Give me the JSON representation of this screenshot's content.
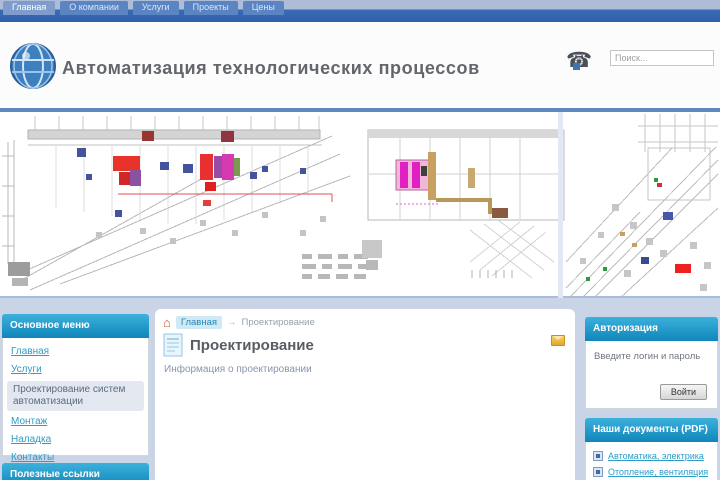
{
  "topnav": {
    "tabs": [
      {
        "label": "Главная"
      },
      {
        "label": "О компании"
      },
      {
        "label": "Услуги"
      },
      {
        "label": "Проекты"
      },
      {
        "label": "Цены"
      }
    ]
  },
  "header": {
    "site_title": "Автоматизация технологических процессов",
    "search_placeholder": "Поиск..."
  },
  "icons": {
    "home": "⌂",
    "phone": "☎"
  },
  "left_sidebar": {
    "menu_title": "Основное меню",
    "items": [
      {
        "label": "Главная"
      },
      {
        "label": "Услуги"
      },
      {
        "label": "Проектирование систем автоматизации"
      },
      {
        "label": "Монтаж"
      },
      {
        "label": "Наладка"
      },
      {
        "label": "Контакты"
      }
    ],
    "bottom_module_title": "Полезные ссылки"
  },
  "content": {
    "breadcrumb": {
      "home": "Главная",
      "separator": "→",
      "current": "Проектирование"
    },
    "article": {
      "title": "Проектирование",
      "subtitle": "Информация о проектировании"
    }
  },
  "right_sidebar": {
    "login": {
      "title": "Авторизация",
      "text": "Введите логин и пароль",
      "button": "Войти"
    },
    "docs": {
      "title": "Наши документы (PDF)",
      "items": [
        {
          "label": "Автоматика, электрика"
        },
        {
          "label": "Отопление, вентиляция"
        }
      ]
    }
  },
  "colors": {
    "topbar_blue": "#3a6cb5",
    "module_header_cyan": "#1e9ccc",
    "link_cyan": "#2b9dc8",
    "page_bg": "#c9d4e7"
  }
}
